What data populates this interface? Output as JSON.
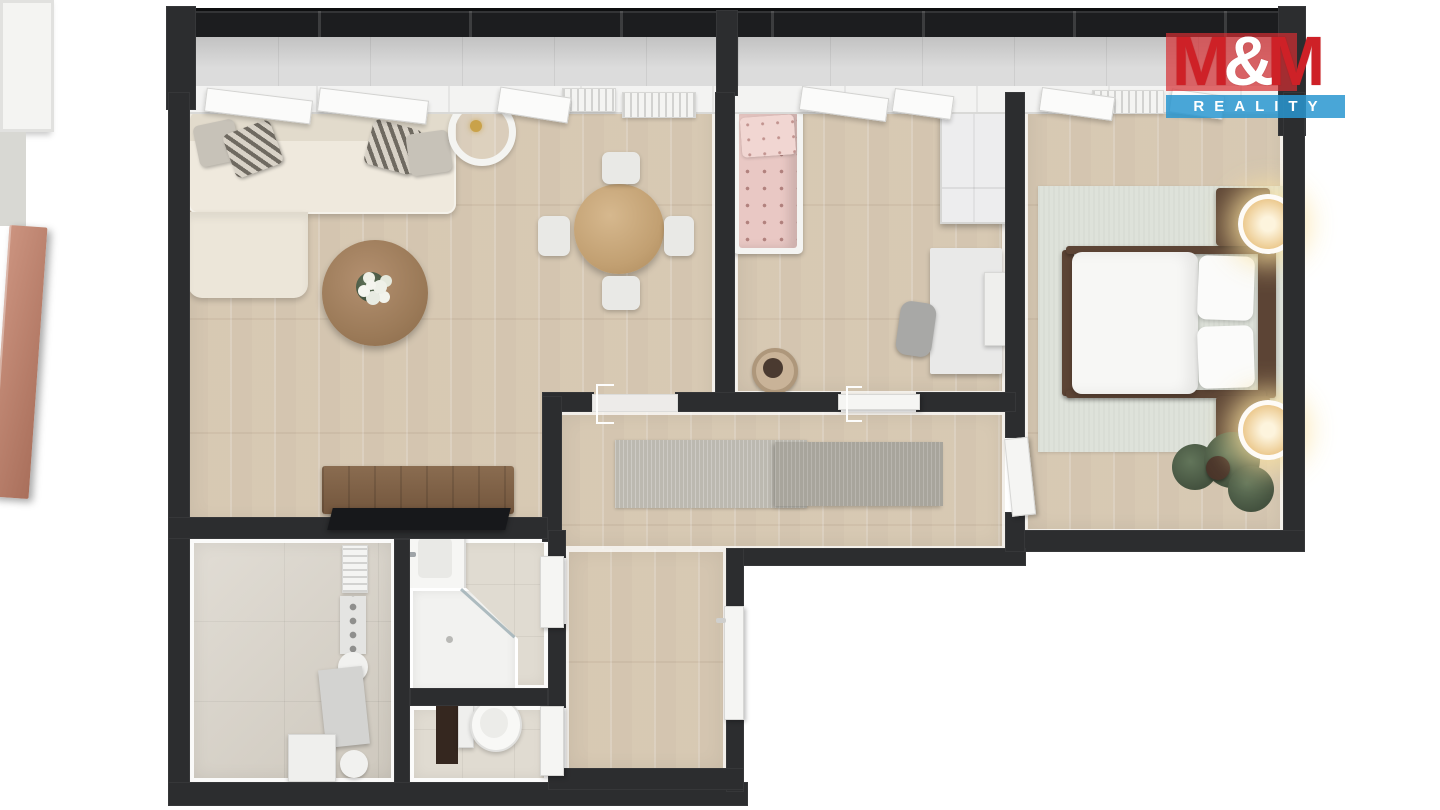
{
  "brand": {
    "m1": "M",
    "amp": "&",
    "m2": "M",
    "tagline": "REALITY",
    "colors": {
      "letters_red": "#ce2127",
      "red_overlay": "rgba(213,45,50,0.70)",
      "blue_overlay": "rgba(41,150,208,0.85)",
      "tagline_text": "#ffffff"
    }
  },
  "floor_plan": {
    "view": "top-down-3d-render",
    "wall_color": "#2c2d2f",
    "floor_colors": {
      "wood": "#dbceba",
      "entry_tile": "#d6d0c5",
      "bath_tile": "#e0dbd1",
      "balcony": "#d8d8d8",
      "rug_sage": "#dee2da",
      "rug_gray_light": "#bcb9b0",
      "rug_gray_dark": "#a8a59c",
      "copper_door": "#bc8470",
      "dark_wood": "#5c4435",
      "counter_brown": "#7d5f45",
      "countertop_black": "#17181b",
      "pink_bedding": "#e9c8c4"
    },
    "rooms": [
      {
        "id": "balcony",
        "features": [
          "dark-railing",
          "glazing-divider",
          "gray-tile-floor"
        ]
      },
      {
        "id": "living-room",
        "furniture": [
          "corner-sofa",
          "throw-pillows-4",
          "floor-lamp-ring",
          "round-coffee-table",
          "white-flowers",
          "round-dining-table",
          "dining-chairs-4",
          "kitchen-counter",
          "black-countertop",
          "radiator-2"
        ]
      },
      {
        "id": "children-room",
        "furniture": [
          "single-bed-pink-bedding",
          "wardrobe",
          "desk",
          "desk-chair",
          "round-basket",
          "wall-panel"
        ]
      },
      {
        "id": "bedroom",
        "furniture": [
          "double-bed-dark-frame",
          "nightstands-2",
          "glowing-table-lamps-2",
          "sage-area-rug",
          "potted-plant",
          "radiator"
        ]
      },
      {
        "id": "hallway",
        "furniture": [
          "runner-rug-light",
          "runner-rug-dark"
        ]
      },
      {
        "id": "entry-hall",
        "furniture": [
          "radiator",
          "wall-hook-panel",
          "boiler-round-2",
          "utility-cabinet",
          "storage-box"
        ]
      },
      {
        "id": "bathroom",
        "furniture": [
          "washbasin",
          "corner-shower-glass"
        ]
      },
      {
        "id": "wc",
        "furniture": [
          "toilet",
          "duct-shaft"
        ]
      }
    ],
    "doors": [
      "exterior-glass-door",
      "copper-entry-room-door",
      "bathroom-door",
      "wc-door",
      "main-entrance-door",
      "bedroom-door",
      "children-room-sliding-door",
      "living-room-open-doorway"
    ],
    "windows": "openable-casement-windows-along-balcony-wall"
  }
}
